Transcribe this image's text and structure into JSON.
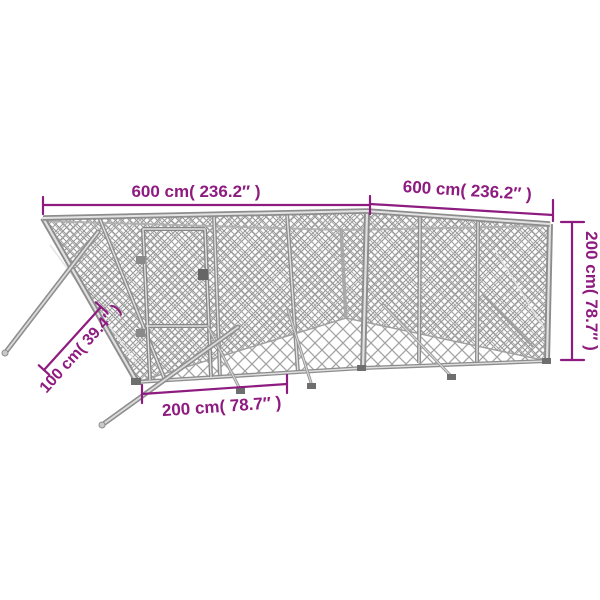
{
  "meta": {
    "title": "Outdoor dog kennel with dimension annotations"
  },
  "colors": {
    "accent": "#8e1b7f",
    "metal": "#8d8d8d",
    "mesh": "#a9a9a9",
    "background": "#ffffff"
  },
  "dimensions": {
    "top_left": {
      "label": "600 cm( 236.2″ )"
    },
    "top_right": {
      "label": "600 cm( 236.2″ )"
    },
    "right": {
      "label": "200 cm( 78.7″ )"
    },
    "bottom": {
      "label": "200 cm( 78.7″ )"
    },
    "diagonal": {
      "label": "100 cm( 39.4″ )"
    }
  }
}
